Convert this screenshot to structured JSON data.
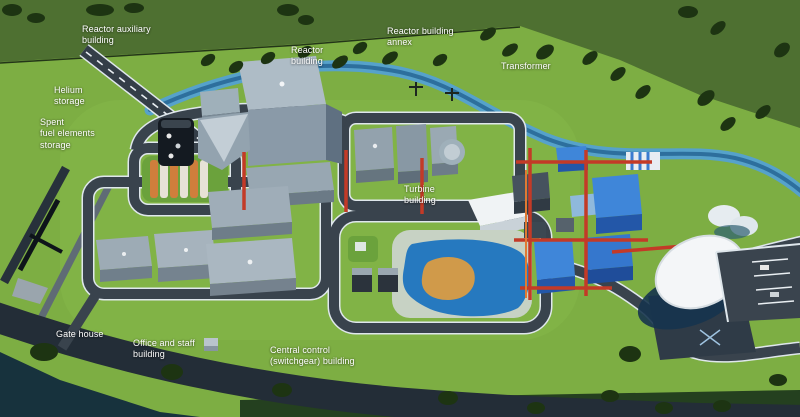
{
  "figure": {
    "type": "3d-site-plan",
    "labels": [
      {
        "id": "reactor-auxiliary-building",
        "text": "Reactor auxiliary\nbuilding"
      },
      {
        "id": "helium-storage",
        "text": "Helium\nstorage"
      },
      {
        "id": "spent-fuel-elements-storage",
        "text": "Spent\nfuel elements\nstorage"
      },
      {
        "id": "reactor-building",
        "text": "Reactor\nbuilding"
      },
      {
        "id": "reactor-building-annex",
        "text": "Reactor building\nannex"
      },
      {
        "id": "transformer",
        "text": "Transformer"
      },
      {
        "id": "turbine-building",
        "text": "Turbine\nbuilding"
      },
      {
        "id": "gate-house",
        "text": "Gate house"
      },
      {
        "id": "office-and-staff-building",
        "text": "Office and staff\nbuilding"
      },
      {
        "id": "central-control-building",
        "text": "Central control\n(switchgear) building"
      }
    ],
    "colors": {
      "label_text": "#ffffff",
      "grass": "#7dae43",
      "forest_band": "#4e7031",
      "tree": "#1d3412",
      "road": "#39434d",
      "road_marking": "#e9eef2",
      "river": "#56a2ca",
      "building_gray_roof": "#a8b6c0",
      "building_gray_wall": "#8a9aa8",
      "building_blue": "#2f6fbe",
      "piping_red": "#c33a27",
      "tank_orange": "#cf7e3c",
      "pond_blue": "#2679bf",
      "pond_island": "#d09a4a",
      "dome_white": "#f4f6f8",
      "dark_water": "#17323d"
    }
  }
}
